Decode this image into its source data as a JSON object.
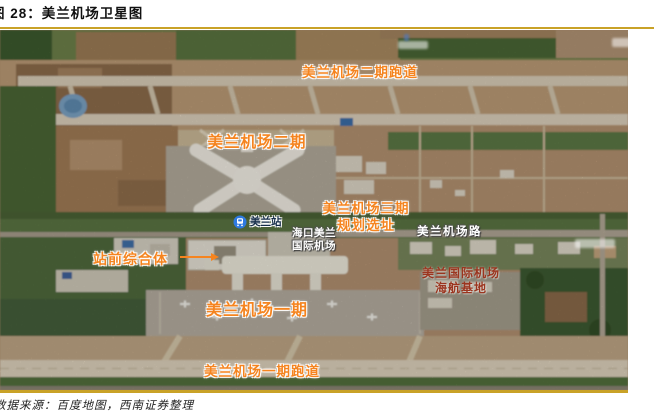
{
  "figure": {
    "number_label": "图 28：美兰机场卫星图",
    "source_note": "数据来源：百度地图，西南证券整理"
  },
  "map": {
    "overlay_annotations": {
      "phase2_runway": "美兰机场二期跑道",
      "phase2": "美兰机场二期",
      "phase3_line1": "美兰机场三期",
      "phase3_line2": "规划选址",
      "station_front_complex": "站前综合体",
      "phase1": "美兰机场一期",
      "phase1_runway": "美兰机场一期跑道"
    },
    "red_annotations": {
      "hna_base_line1": "美兰国际机场",
      "hna_base_line2": "海航基地"
    },
    "map_labels": {
      "airport_name_line1": "海口美兰",
      "airport_name_line2": "国际机场",
      "road_name": "美兰机场路",
      "rail_station": "美兰站"
    },
    "colors": {
      "annotation_orange": "#f5841f",
      "annotation_dark_red": "#9b351f",
      "road_label_white": "#ffffff",
      "station_marker_blue": "#2e7ae0",
      "figure_rule_gold": "#c9a227"
    }
  }
}
